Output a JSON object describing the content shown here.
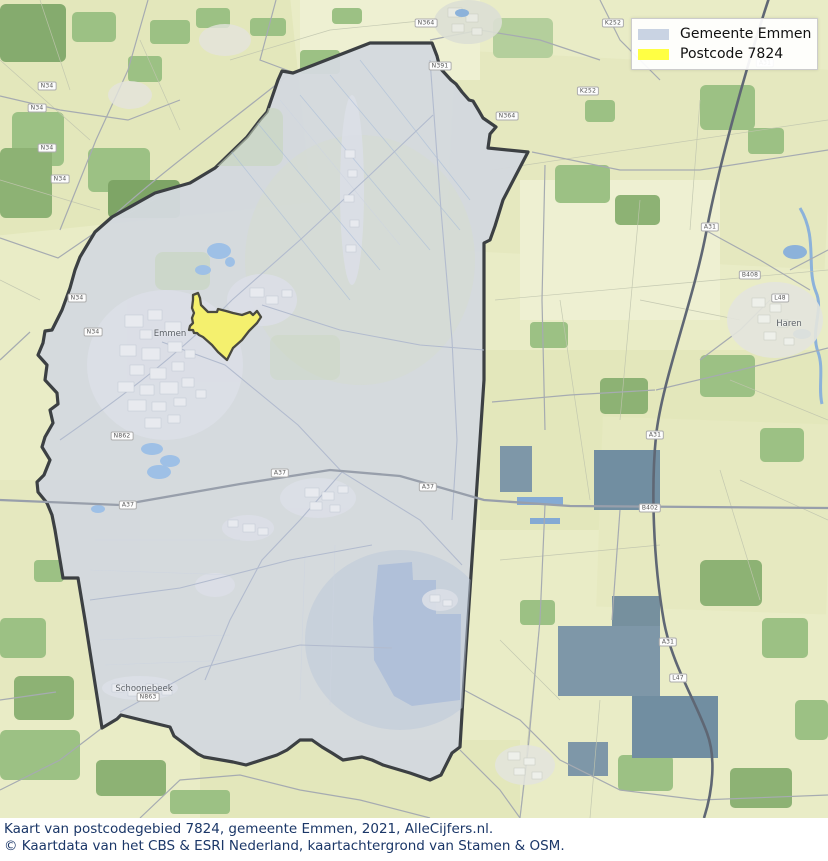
{
  "legend": {
    "items": [
      {
        "label": "Gemeente Emmen",
        "color": "#c9d3e3"
      },
      {
        "label": "Postcode 7824",
        "color": "#ffff44"
      }
    ]
  },
  "caption": {
    "line1": "Kaart van postcodegebied 7824, gemeente Emmen, 2021, AlleCijfers.nl.",
    "line2": "© Kaartdata van het CBS & ESRI Nederland, kaartachtergrond van Stamen & OSM."
  },
  "map": {
    "regions": [
      {
        "name": "Gemeente Emmen",
        "fill": "#d3d8de",
        "stroke": "#3c4043"
      },
      {
        "name": "Postcode 7824",
        "fill": "#f4f06e",
        "stroke": "#4a4a40"
      }
    ],
    "town_labels": [
      {
        "label": "Emmen",
        "x": 170,
        "y": 334
      },
      {
        "label": "Schoonebeek",
        "x": 144,
        "y": 689
      },
      {
        "label": "Haren",
        "x": 789,
        "y": 324
      }
    ],
    "road_shields": [
      {
        "label": "N34",
        "x": 47,
        "y": 86
      },
      {
        "label": "N34",
        "x": 37,
        "y": 108
      },
      {
        "label": "N34",
        "x": 47,
        "y": 148
      },
      {
        "label": "N34",
        "x": 60,
        "y": 179
      },
      {
        "label": "N34",
        "x": 77,
        "y": 298
      },
      {
        "label": "N34",
        "x": 93,
        "y": 332
      },
      {
        "label": "N364",
        "x": 426,
        "y": 23
      },
      {
        "label": "N364",
        "x": 507,
        "y": 116
      },
      {
        "label": "N391",
        "x": 440,
        "y": 66
      },
      {
        "label": "N862",
        "x": 122,
        "y": 436
      },
      {
        "label": "N863",
        "x": 148,
        "y": 697
      },
      {
        "label": "A37",
        "x": 128,
        "y": 505
      },
      {
        "label": "A37",
        "x": 280,
        "y": 473
      },
      {
        "label": "A37",
        "x": 428,
        "y": 487
      },
      {
        "label": "A31",
        "x": 765,
        "y": 63
      },
      {
        "label": "A31",
        "x": 710,
        "y": 227
      },
      {
        "label": "A31",
        "x": 655,
        "y": 435
      },
      {
        "label": "A31",
        "x": 668,
        "y": 642
      },
      {
        "label": "B402",
        "x": 650,
        "y": 508
      },
      {
        "label": "B408",
        "x": 750,
        "y": 275
      },
      {
        "label": "L48",
        "x": 780,
        "y": 298
      },
      {
        "label": "L47",
        "x": 678,
        "y": 678
      },
      {
        "label": "K252",
        "x": 613,
        "y": 23
      },
      {
        "label": "K252",
        "x": 588,
        "y": 91
      }
    ]
  }
}
